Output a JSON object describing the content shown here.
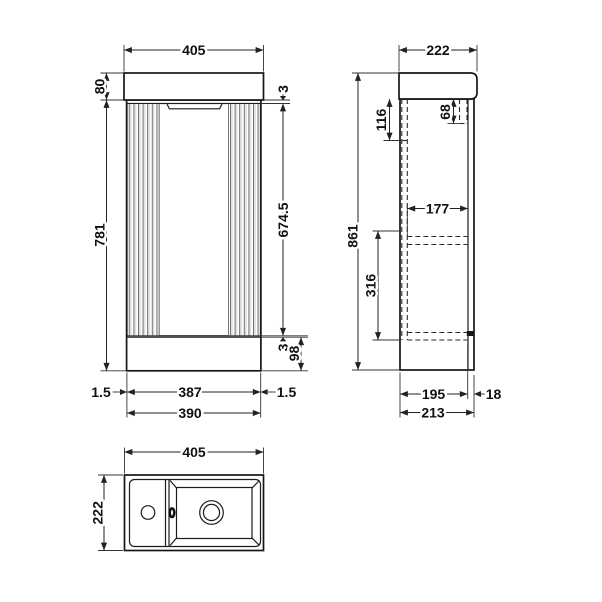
{
  "colors": {
    "line": "#1a1a1a",
    "background": "#ffffff",
    "flute_shade": "#e2e2e2"
  },
  "front": {
    "width": "405",
    "counter_height": "80",
    "carcass_height": "781",
    "top_gap": "3",
    "door_height": "674.5",
    "bottom_gap": "3",
    "plinth_height": "98",
    "door_gap_left": "1.5",
    "door_width": "387",
    "door_gap_right": "1.5",
    "carcass_width": "390"
  },
  "side": {
    "depth": "222",
    "door_top_detail": "116",
    "back_bracket": "68",
    "overall_height": "861",
    "shelf_depth": "177",
    "shelf_clearance": "316",
    "base_depth": "195",
    "back_offset": "18",
    "overall_depth": "213"
  },
  "top": {
    "width": "405",
    "depth": "222"
  }
}
